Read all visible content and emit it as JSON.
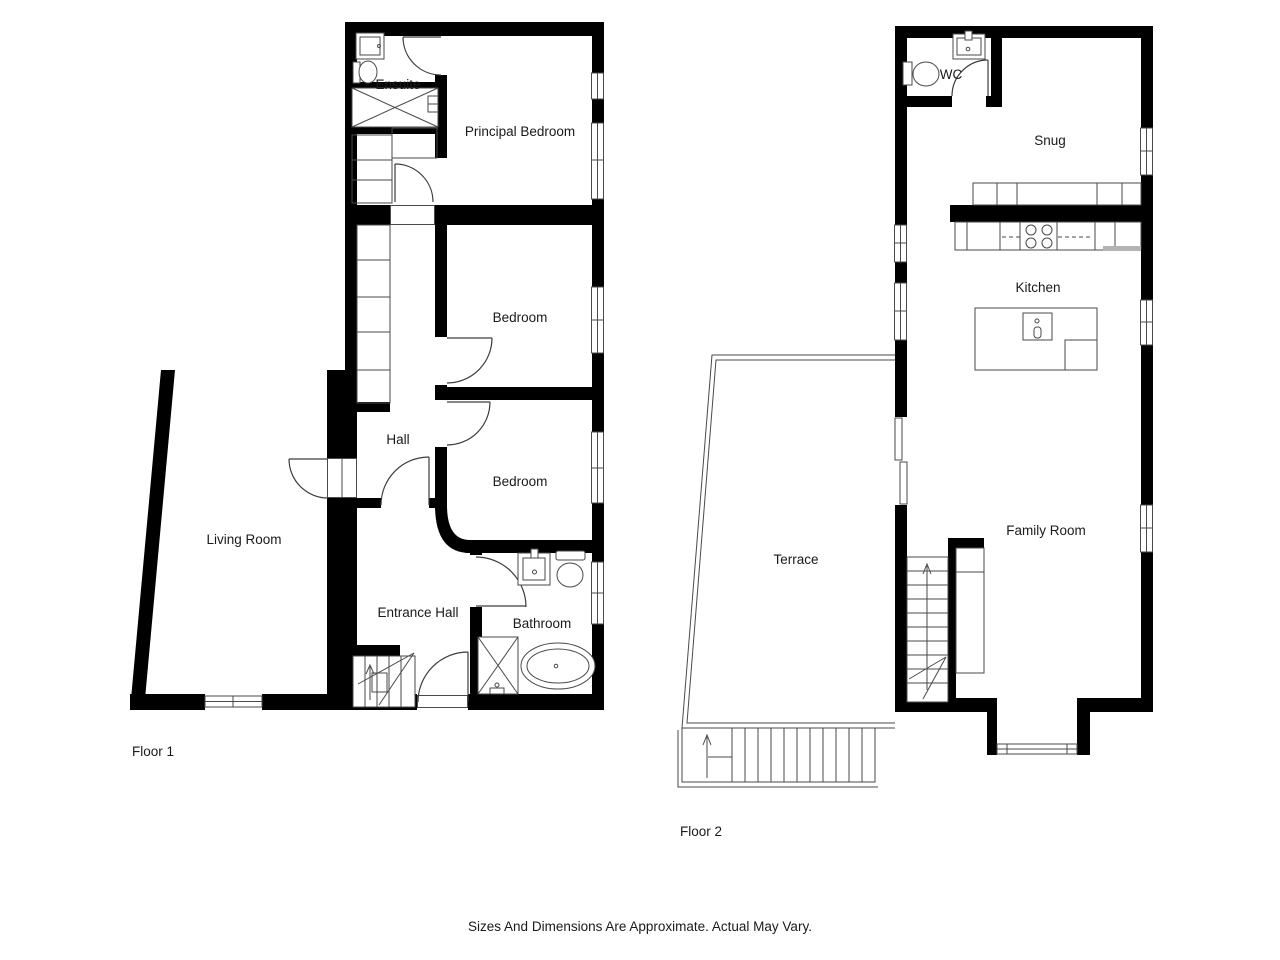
{
  "floor1": {
    "label": "Floor 1",
    "rooms": {
      "ensuite": "Ensuite",
      "principal_bedroom": "Principal Bedroom",
      "bedroom_middle": "Bedroom",
      "hall": "Hall",
      "bedroom_lower": "Bedroom",
      "living_room": "Living Room",
      "entrance_hall": "Entrance Hall",
      "bathroom": "Bathroom"
    }
  },
  "floor2": {
    "label": "Floor 2",
    "rooms": {
      "wc": "WC",
      "snug": "Snug",
      "kitchen": "Kitchen",
      "terrace": "Terrace",
      "family_room": "Family Room"
    }
  },
  "footer": {
    "disclaimer": "Sizes And Dimensions Are Approximate. Actual May Vary."
  },
  "colors": {
    "wall": "#000000",
    "line": "#4a4a4a",
    "background": "#ffffff",
    "text": "#1a1a1a",
    "counter_shade": "#b3b3b3"
  }
}
